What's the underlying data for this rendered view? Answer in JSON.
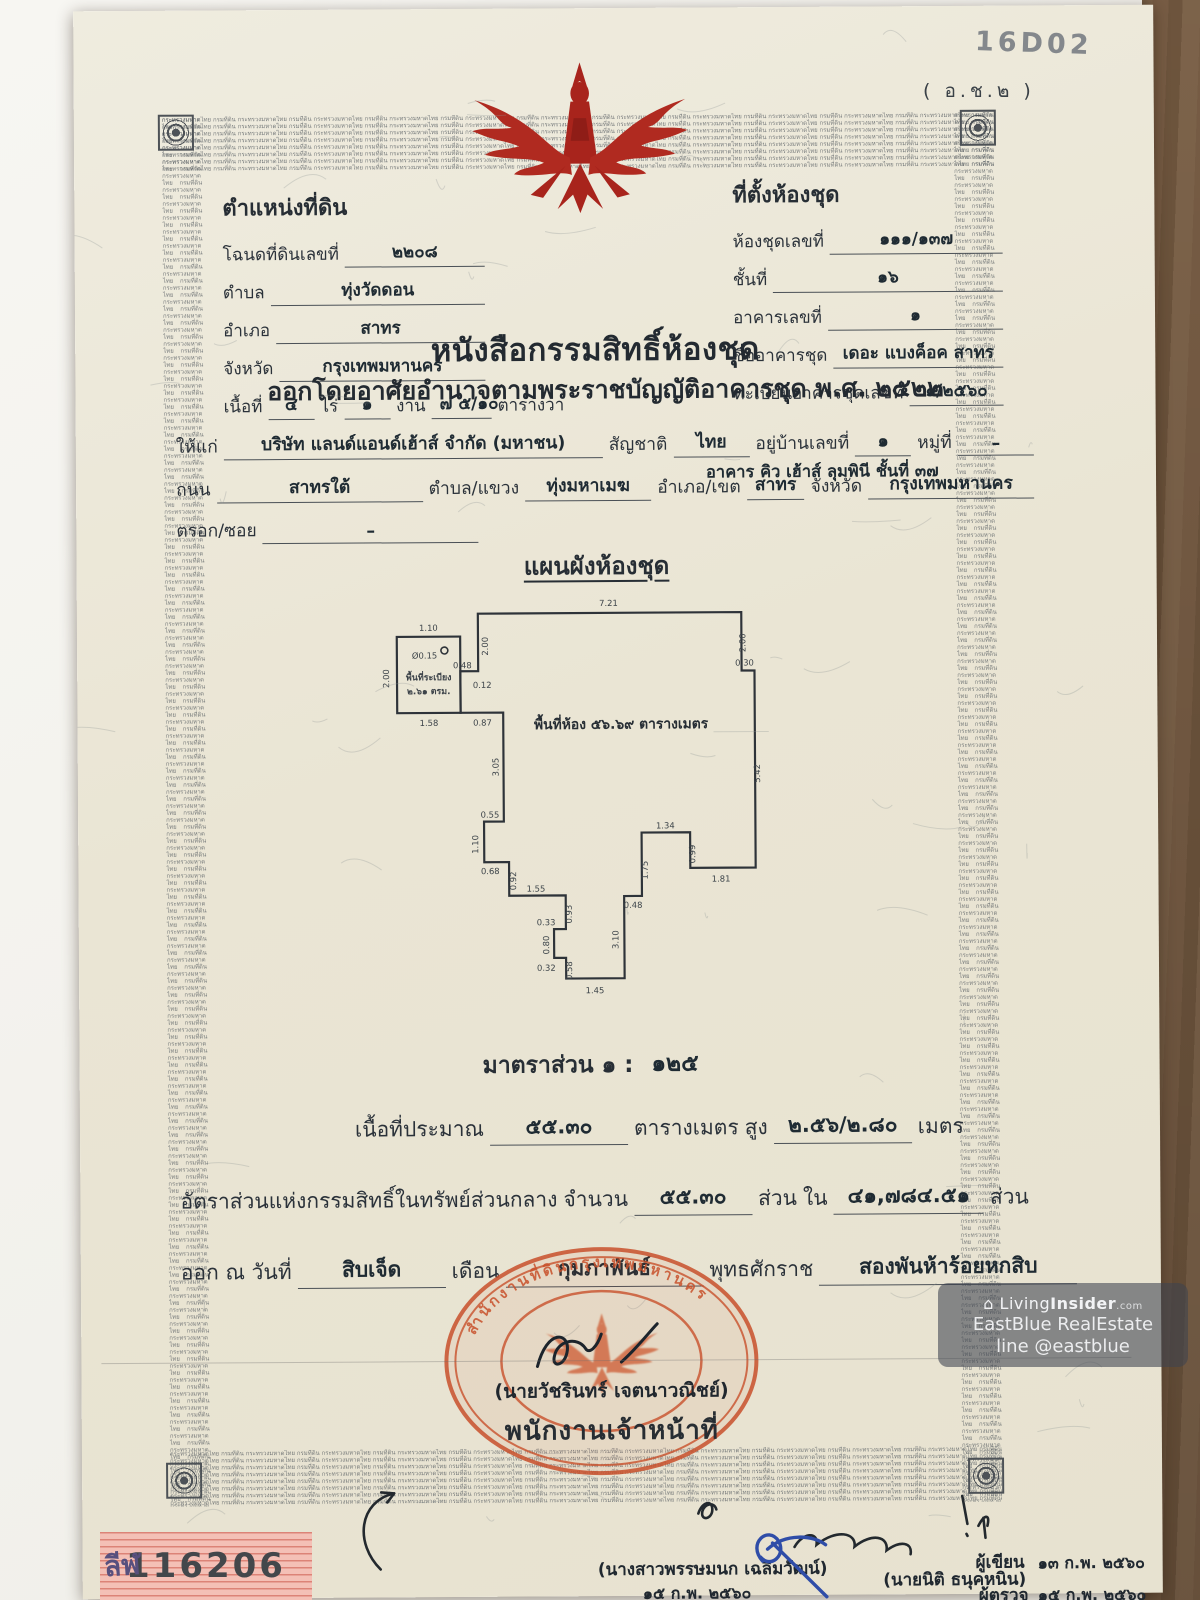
{
  "annotations": {
    "handwritten_code": "16D02",
    "form_code": "( อ.ช.๒ )"
  },
  "security_border": {
    "micro_text": "กระทรวงมหาดไทย กรมที่ดิน "
  },
  "emblem": {
    "name": "garuda",
    "color": "#a8241c"
  },
  "deed": {
    "title": "หนังสือกรรมสิทธิ์ห้องชุด",
    "subtitle": "ออกโดยอาศัยอำนาจตามพระราชบัญญัติอาคารชุด พ.ศ. ๒๕๒๒"
  },
  "land_position": {
    "title": "ตำแหน่งที่ดิน",
    "rows": [
      [
        {
          "k": "l",
          "t": "โฉนดที่ดินเลขที่"
        },
        {
          "k": "v",
          "t": "๒๒๐๘",
          "g": 1
        }
      ],
      [
        {
          "k": "l",
          "t": "ตำบล"
        },
        {
          "k": "v",
          "t": "ทุ่งวัดดอน",
          "g": 1
        }
      ],
      [
        {
          "k": "l",
          "t": "อำเภอ"
        },
        {
          "k": "v",
          "t": "สาทร",
          "g": 1
        }
      ],
      [
        {
          "k": "l",
          "t": "จังหวัด"
        },
        {
          "k": "v",
          "t": "กรุงเทพมหานคร",
          "g": 1
        }
      ],
      [
        {
          "k": "l",
          "t": "เนื้อที่"
        },
        {
          "k": "v",
          "t": "๔",
          "m": 30
        },
        {
          "k": "l",
          "t": "ไร่"
        },
        {
          "k": "v",
          "t": "๑",
          "m": 30
        },
        {
          "k": "l",
          "t": "งาน"
        },
        {
          "k": "v",
          "t": "๗ ๕/๑๐",
          "m": 44
        },
        {
          "k": "l",
          "t": "ตารางวา"
        }
      ]
    ]
  },
  "condo_location": {
    "title": "ที่ตั้งห้องชุด",
    "rows": [
      [
        {
          "k": "l",
          "t": "ห้องชุดเลขที่"
        },
        {
          "k": "v",
          "t": "๑๑๑/๑๓๗",
          "g": 1
        }
      ],
      [
        {
          "k": "l",
          "t": "ชั้นที่"
        },
        {
          "k": "v",
          "t": "๑๖",
          "g": 1
        }
      ],
      [
        {
          "k": "l",
          "t": "อาคารเลขที่"
        },
        {
          "k": "v",
          "t": "๑",
          "g": 1
        }
      ],
      [
        {
          "k": "l",
          "t": "ชื่ออาคารชุด"
        },
        {
          "k": "v",
          "t": "เดอะ แบงค็อค สาทร",
          "g": 1
        }
      ],
      [
        {
          "k": "l",
          "t": "ทะเบียนอาคารชุดเลขที่"
        },
        {
          "k": "v",
          "t": "๑/๒๕๖๐",
          "g": 1
        }
      ]
    ]
  },
  "grantee": {
    "rows": [
      [
        {
          "k": "l",
          "t": "ให้แก่"
        },
        {
          "k": "v",
          "t": "บริษัท แลนด์แอนด์เฮ้าส์ จำกัด (มหาชน)",
          "g": 2
        },
        {
          "k": "l",
          "t": "สัญชาติ"
        },
        {
          "k": "v",
          "t": "ไทย",
          "g": 1
        },
        {
          "k": "l",
          "t": "อยู่บ้านเลขที่"
        },
        {
          "k": "v",
          "t": "๑",
          "m": 40
        },
        {
          "k": "l",
          "t": "หมู่ที่"
        },
        {
          "k": "v",
          "t": "–",
          "m": 60
        }
      ],
      [
        {
          "k": "l",
          "t": "ถนน"
        },
        {
          "k": "v",
          "t": "สาทรใต้",
          "m": 190
        },
        {
          "k": "l",
          "t": "ตำบล/แขวง"
        },
        {
          "k": "v",
          "t": "ทุ่งมหาเมฆ",
          "m": 110
        },
        {
          "k": "l",
          "t": "อำเภอ/เขต"
        },
        {
          "k": "v",
          "t": "สาทร",
          "g": 1
        },
        {
          "k": "l",
          "t": "จังหวัด"
        },
        {
          "k": "v",
          "t": "กรุงเทพมหานคร",
          "m": 150
        }
      ],
      [
        {
          "k": "l",
          "t": "ตรอก/ซอย"
        },
        {
          "k": "v",
          "t": "–",
          "m": 200
        }
      ]
    ],
    "address_line2": "อาคาร คิว เฮ้าส์ ลุมพินี ชั้นที่ ๓๗"
  },
  "floor_plan": {
    "title": "แผนผังห้องชุด",
    "room_area_text": "พื้นที่ห้อง ๕๖.๖๙ ตารางเมตร",
    "balcony_line1": "พื้นที่ระเบียง",
    "balcony_line2": "๒.๖๑ ตรม.",
    "scale_label": "มาตราส่วน  ๑ :",
    "scale_value": "๑๒๕",
    "dimensions": [
      {
        "t": "7.21",
        "x": 222,
        "y": 30
      },
      {
        "t": "1.10",
        "x": 40,
        "y": 54
      },
      {
        "t": "Ø0.15",
        "x": 36,
        "y": 82
      },
      {
        "t": "2.00",
        "x": 0,
        "y": 102,
        "r": -90
      },
      {
        "t": "2.00",
        "x": 100,
        "y": 70,
        "r": -90
      },
      {
        "t": "0.48",
        "x": 74,
        "y": 92
      },
      {
        "t": "0.12",
        "x": 94,
        "y": 112
      },
      {
        "t": "1.58",
        "x": 40,
        "y": 150
      },
      {
        "t": "0.87",
        "x": 94,
        "y": 150
      },
      {
        "t": "3.05",
        "x": 110,
        "y": 192,
        "r": -90
      },
      {
        "t": "0.55",
        "x": 101,
        "y": 243
      },
      {
        "t": "1.10",
        "x": 89,
        "y": 270,
        "r": -90
      },
      {
        "t": "0.68",
        "x": 101,
        "y": 300
      },
      {
        "t": "0.92",
        "x": 127,
        "y": 307,
        "r": -90
      },
      {
        "t": "1.55",
        "x": 147,
        "y": 318
      },
      {
        "t": "0.93",
        "x": 183,
        "y": 341,
        "r": -90
      },
      {
        "t": "0.33",
        "x": 157,
        "y": 352
      },
      {
        "t": "0.80",
        "x": 160,
        "y": 372,
        "r": -90
      },
      {
        "t": "0.32",
        "x": 157,
        "y": 398
      },
      {
        "t": "0.58",
        "x": 183,
        "y": 398,
        "r": -90
      },
      {
        "t": "1.45",
        "x": 206,
        "y": 421
      },
      {
        "t": "3.10",
        "x": 230,
        "y": 367,
        "r": -90
      },
      {
        "t": "0.48",
        "x": 245,
        "y": 335
      },
      {
        "t": "1.75",
        "x": 260,
        "y": 297,
        "r": -90
      },
      {
        "t": "1.34",
        "x": 278,
        "y": 255
      },
      {
        "t": "0.99",
        "x": 308,
        "y": 281,
        "r": -90
      },
      {
        "t": "1.81",
        "x": 334,
        "y": 309
      },
      {
        "t": "5.42",
        "x": 374,
        "y": 200,
        "r": -90
      },
      {
        "t": "2.00",
        "x": 360,
        "y": 68,
        "r": -90
      },
      {
        "t": "0.30",
        "x": 359,
        "y": 91
      }
    ]
  },
  "details": {
    "rows": [
      [
        {
          "k": "l",
          "t": "เนื้อที่ประมาณ"
        },
        {
          "k": "v",
          "t": "๕๕.๓๐",
          "m": 110
        },
        {
          "k": "l",
          "t": "ตารางเมตร"
        },
        {
          "k": "l",
          "t": "สูง"
        },
        {
          "k": "v",
          "t": "๒.๕๖/๒.๘๐",
          "m": 110
        },
        {
          "k": "l",
          "t": "เมตร"
        }
      ],
      [
        {
          "k": "l",
          "t": "อัตราส่วนแห่งกรรมสิทธิ์ในทรัพย์ส่วนกลาง"
        },
        {
          "k": "l",
          "t": "จำนวน"
        },
        {
          "k": "v",
          "t": "๕๕.๓๐",
          "m": 90
        },
        {
          "k": "l",
          "t": "ส่วน"
        },
        {
          "k": "l",
          "t": "ใน"
        },
        {
          "k": "v",
          "t": "๔๑,๗๘๔.๕๑",
          "m": 120
        },
        {
          "k": "l",
          "t": "ส่วน"
        }
      ],
      [
        {
          "k": "l",
          "t": "ออก ณ วันที่"
        },
        {
          "k": "v",
          "t": "สิบเจ็ด",
          "m": 120
        },
        {
          "k": "l",
          "t": "เดือน"
        },
        {
          "k": "v",
          "t": "กุมภาพันธ์",
          "m": 170
        },
        {
          "k": "l",
          "t": "พุทธศักราช"
        },
        {
          "k": "v",
          "t": "สองพันห้าร้อยหกสิบ",
          "m": 230
        }
      ]
    ]
  },
  "officer": {
    "signature_name": "(นายวัชรินทร์ เจตนาวณิชย์)",
    "role": "พนักงานเจ้าหน้าที่",
    "stamp_arc_text": "สำนักงานที่ดินกรุงเทพมหานคร",
    "stamp_color": "#c8502b"
  },
  "footer": {
    "left_name": "(นางสาวพรรษมนก เฉลิมวัฒน์)",
    "left_date": "๑๕ ก.พ. ๒๕๖๐",
    "mid_name": "(นายนิติ ธนุคหนิน)",
    "writer_label": "ผู้เขียน",
    "writer_date": "๑๓ ก.พ. ๒๕๖๐",
    "checker_label": "ผู้ตรวจ",
    "checker_date": "๑๕ ก.พ. ๒๕๖๐"
  },
  "stamp_number": {
    "prefix": "ลีฬ",
    "number": "116206"
  },
  "watermark": {
    "logo_glyph": "⌂",
    "brand_prefix": "Living",
    "brand_bold": "Insider",
    "brand_suffix": ".com",
    "line2": "EastBlue RealEstate",
    "line3": "line @eastblue"
  }
}
